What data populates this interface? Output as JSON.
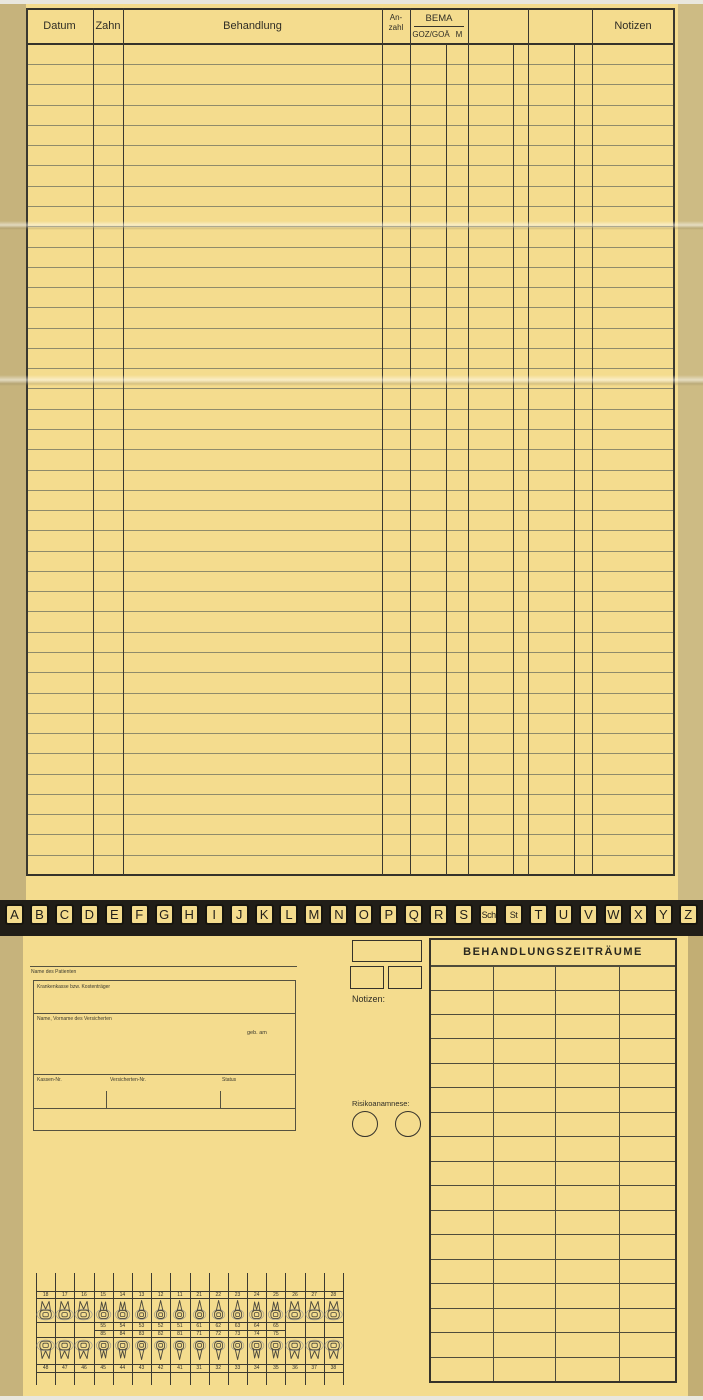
{
  "treatment_table": {
    "headers": {
      "datum": "Datum",
      "zahn": "Zahn",
      "behandlung": "Behandlung",
      "anzahl_line1": "An-",
      "anzahl_line2": "zahl",
      "bema": "BEMA",
      "goz_goa": "GOZ/GOÄ",
      "m": "M",
      "notizen": "Notizen"
    },
    "row_count": 41
  },
  "alphabet_tabs": [
    "A",
    "B",
    "C",
    "D",
    "E",
    "F",
    "G",
    "H",
    "I",
    "J",
    "K",
    "L",
    "M",
    "N",
    "O",
    "P",
    "Q",
    "R",
    "S",
    "Sch",
    "St",
    "T",
    "U",
    "V",
    "W",
    "X",
    "Y",
    "Z"
  ],
  "patient_box": {
    "name_des_patienten": "Name des Patienten",
    "krankenkasse": "Krankenkasse bzw. Kostenträger",
    "versicherter": "Name, Vorname des Versicherten",
    "geb_am": "geb. am",
    "kassen_nr": "Kassen-Nr.",
    "versicherten_nr": "Versicherten-Nr.",
    "status": "Status"
  },
  "notizen_label": "Notizen:",
  "risikoanamnese_label": "Risikoanamnese:",
  "behandlungszeitraeume": {
    "title": "BEHANDLUNGSZEITRÄUME",
    "row_count": 17,
    "col_count": 4
  },
  "tooth_chart": {
    "upper": [
      "18",
      "17",
      "16",
      "15",
      "14",
      "13",
      "12",
      "11",
      "21",
      "22",
      "23",
      "24",
      "25",
      "26",
      "27",
      "28"
    ],
    "upper_deciduous": [
      "55",
      "54",
      "53",
      "52",
      "51",
      "61",
      "62",
      "63",
      "64",
      "65"
    ],
    "lower_deciduous": [
      "85",
      "84",
      "83",
      "82",
      "81",
      "71",
      "72",
      "73",
      "74",
      "75"
    ],
    "lower": [
      "48",
      "47",
      "46",
      "45",
      "44",
      "43",
      "42",
      "41",
      "31",
      "32",
      "33",
      "34",
      "35",
      "36",
      "37",
      "38"
    ]
  },
  "colors": {
    "card_yellow": "#f4dc8e",
    "edge_tan": "#c6b37c",
    "band_dark": "#211e18",
    "line_dark": "#35332a",
    "line_soft": "#8f8b6a"
  }
}
